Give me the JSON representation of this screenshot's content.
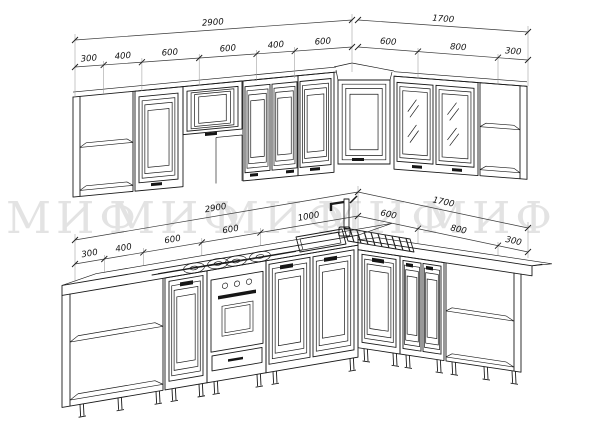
{
  "drawing": {
    "type": "kitchen-elevation-technical-drawing",
    "watermark": {
      "text": "МИФ",
      "color": "#e3e3e3"
    },
    "upper_row": {
      "overall_left": "2900",
      "segments_left": [
        "300",
        "400",
        "600",
        "600",
        "400",
        "600"
      ],
      "overall_right": "1700",
      "segments_right": [
        "600",
        "800",
        "300"
      ]
    },
    "lower_row": {
      "overall_left": "2900",
      "segments_left": [
        "300",
        "400",
        "600",
        "600",
        "1000"
      ],
      "overall_right": "1700",
      "segments_right": [
        "600",
        "800",
        "300"
      ]
    },
    "colors": {
      "line": "#1a1a1a",
      "dimension": "#3a3a3a",
      "extension": "#9a9a9a",
      "watermark": "#e3e3e3",
      "background": "#ffffff"
    }
  }
}
